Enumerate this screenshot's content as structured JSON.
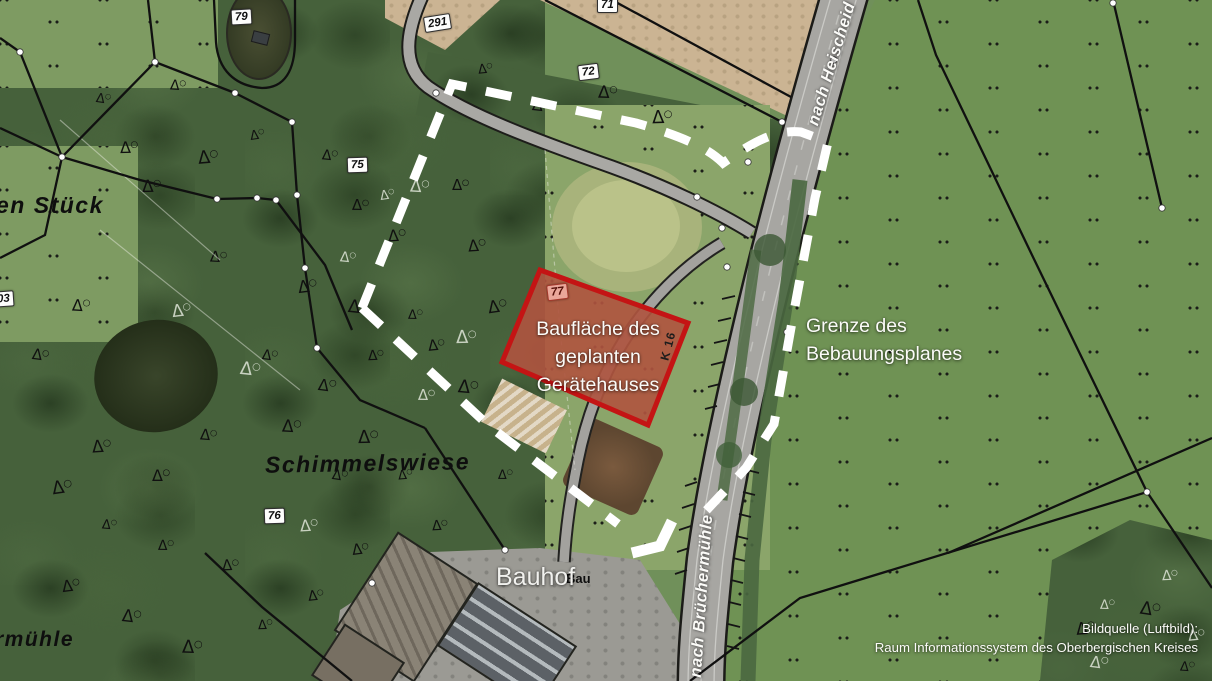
{
  "map": {
    "planning_area": {
      "lines": [
        "Baufläche des",
        "geplanten",
        "Gerätehauses"
      ]
    },
    "boundary_label": {
      "lines": [
        "Grenze des",
        "Bebauungsplanes"
      ]
    },
    "roads": {
      "heischeid": "nach Heischeid",
      "bruechermuehle": "nach Brüchermühle",
      "k16": "K 16"
    },
    "places": {
      "schimmelswiese": "Schimmelswiese",
      "bauhof": "Bauhof",
      "bauhof_partial": "Bau",
      "stueck_partial": "en Stück",
      "muehle_partial": "rmühle"
    },
    "parcels": {
      "p79": "79",
      "p291": "291",
      "p71": "71",
      "p72": "72",
      "p75": "75",
      "p77": "77",
      "p76": "76",
      "p03": "03"
    },
    "attribution": {
      "line1": "Bildquelle (Luftbild):",
      "line2": "Raum Informationssystem des Oberbergischen Kreises"
    },
    "colors": {
      "planning_area_stroke": "#c41414",
      "planning_area_fill": "rgba(198,40,28,0.42)",
      "boundary_dash": "#ffffff",
      "forest": "#46613b",
      "meadow": "#6f9254",
      "field": "#cbb493",
      "road": "#a7a6a2"
    }
  }
}
